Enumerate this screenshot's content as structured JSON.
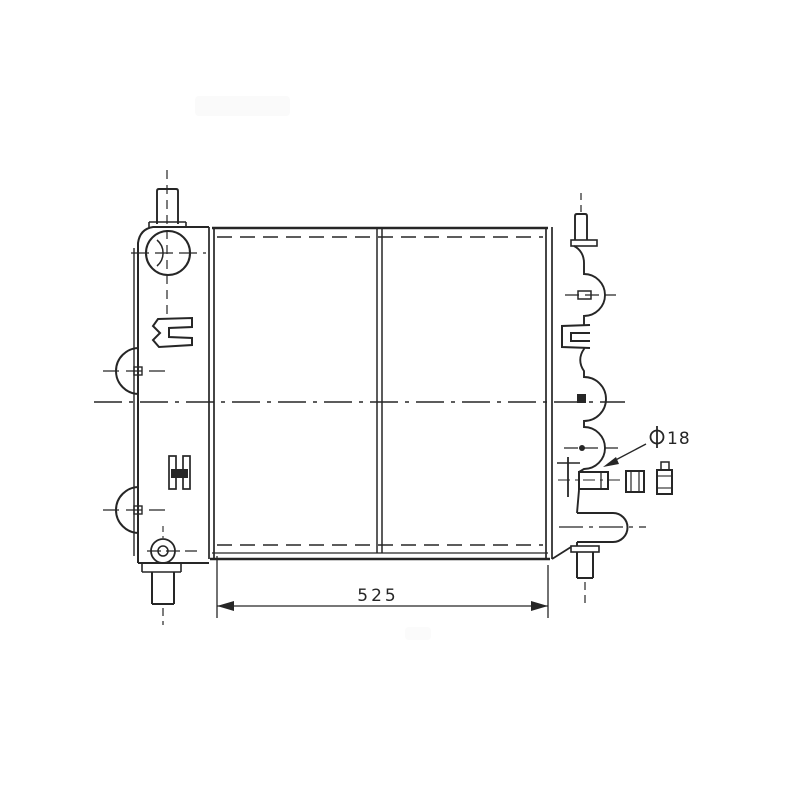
{
  "page": {
    "background_color": "#ffffff",
    "ink_color": "#262626"
  },
  "drawing": {
    "kind": "scanned technical line drawing",
    "annotations": {
      "core_width_dimension": "525",
      "port_diameter_symbol": "⌀",
      "port_diameter_value": "18"
    }
  }
}
